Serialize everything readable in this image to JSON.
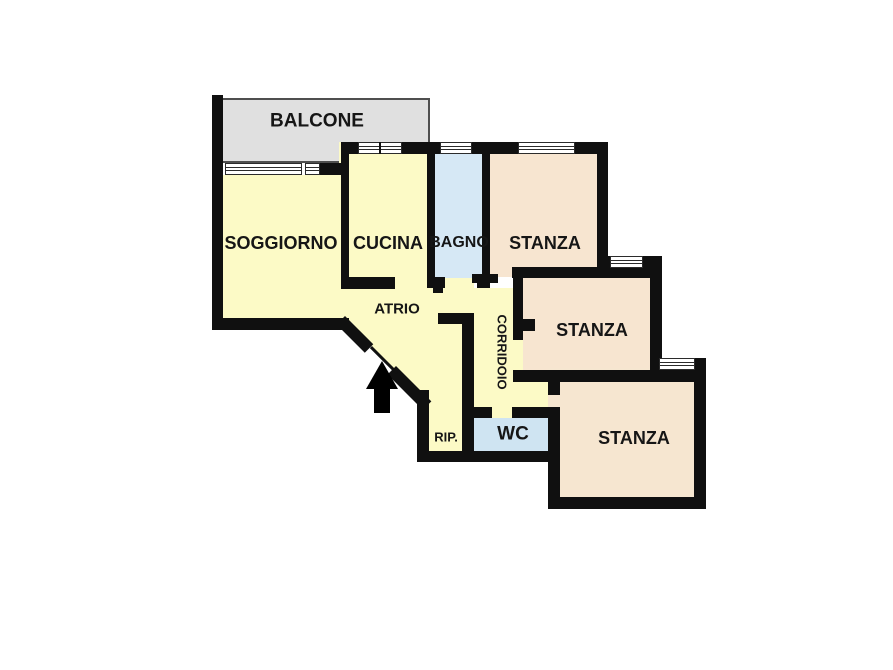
{
  "plan": {
    "type": "apartment-floor-plan",
    "language": "it",
    "wall_color": "#101010",
    "background_color": "#ffffff",
    "rooms": [
      {
        "id": "balcone",
        "label": "BALCONE",
        "color": "#e0e0e0"
      },
      {
        "id": "soggiorno",
        "label": "SOGGIORNO",
        "color": "#fcfac6"
      },
      {
        "id": "cucina",
        "label": "CUCINA",
        "color": "#fcfac6"
      },
      {
        "id": "bagno",
        "label": "BAGNO",
        "color": "#d6e8f5"
      },
      {
        "id": "stanza-top",
        "label": "STANZA",
        "color": "#f7e5d0"
      },
      {
        "id": "stanza-middle",
        "label": "STANZA",
        "color": "#f7e5d0"
      },
      {
        "id": "stanza-bottom",
        "label": "STANZA",
        "color": "#f6e6d0"
      },
      {
        "id": "atrio",
        "label": "ATRIO",
        "color": "#fcfac6"
      },
      {
        "id": "corridoio",
        "label": "CORRIDOIO",
        "color": "#fcfac6"
      },
      {
        "id": "rip",
        "label": "RIP.",
        "color": "#fcfac6"
      },
      {
        "id": "wc",
        "label": "WC",
        "color": "#cfe4f2"
      }
    ],
    "entrance": {
      "symbol": "arrow-up"
    }
  }
}
